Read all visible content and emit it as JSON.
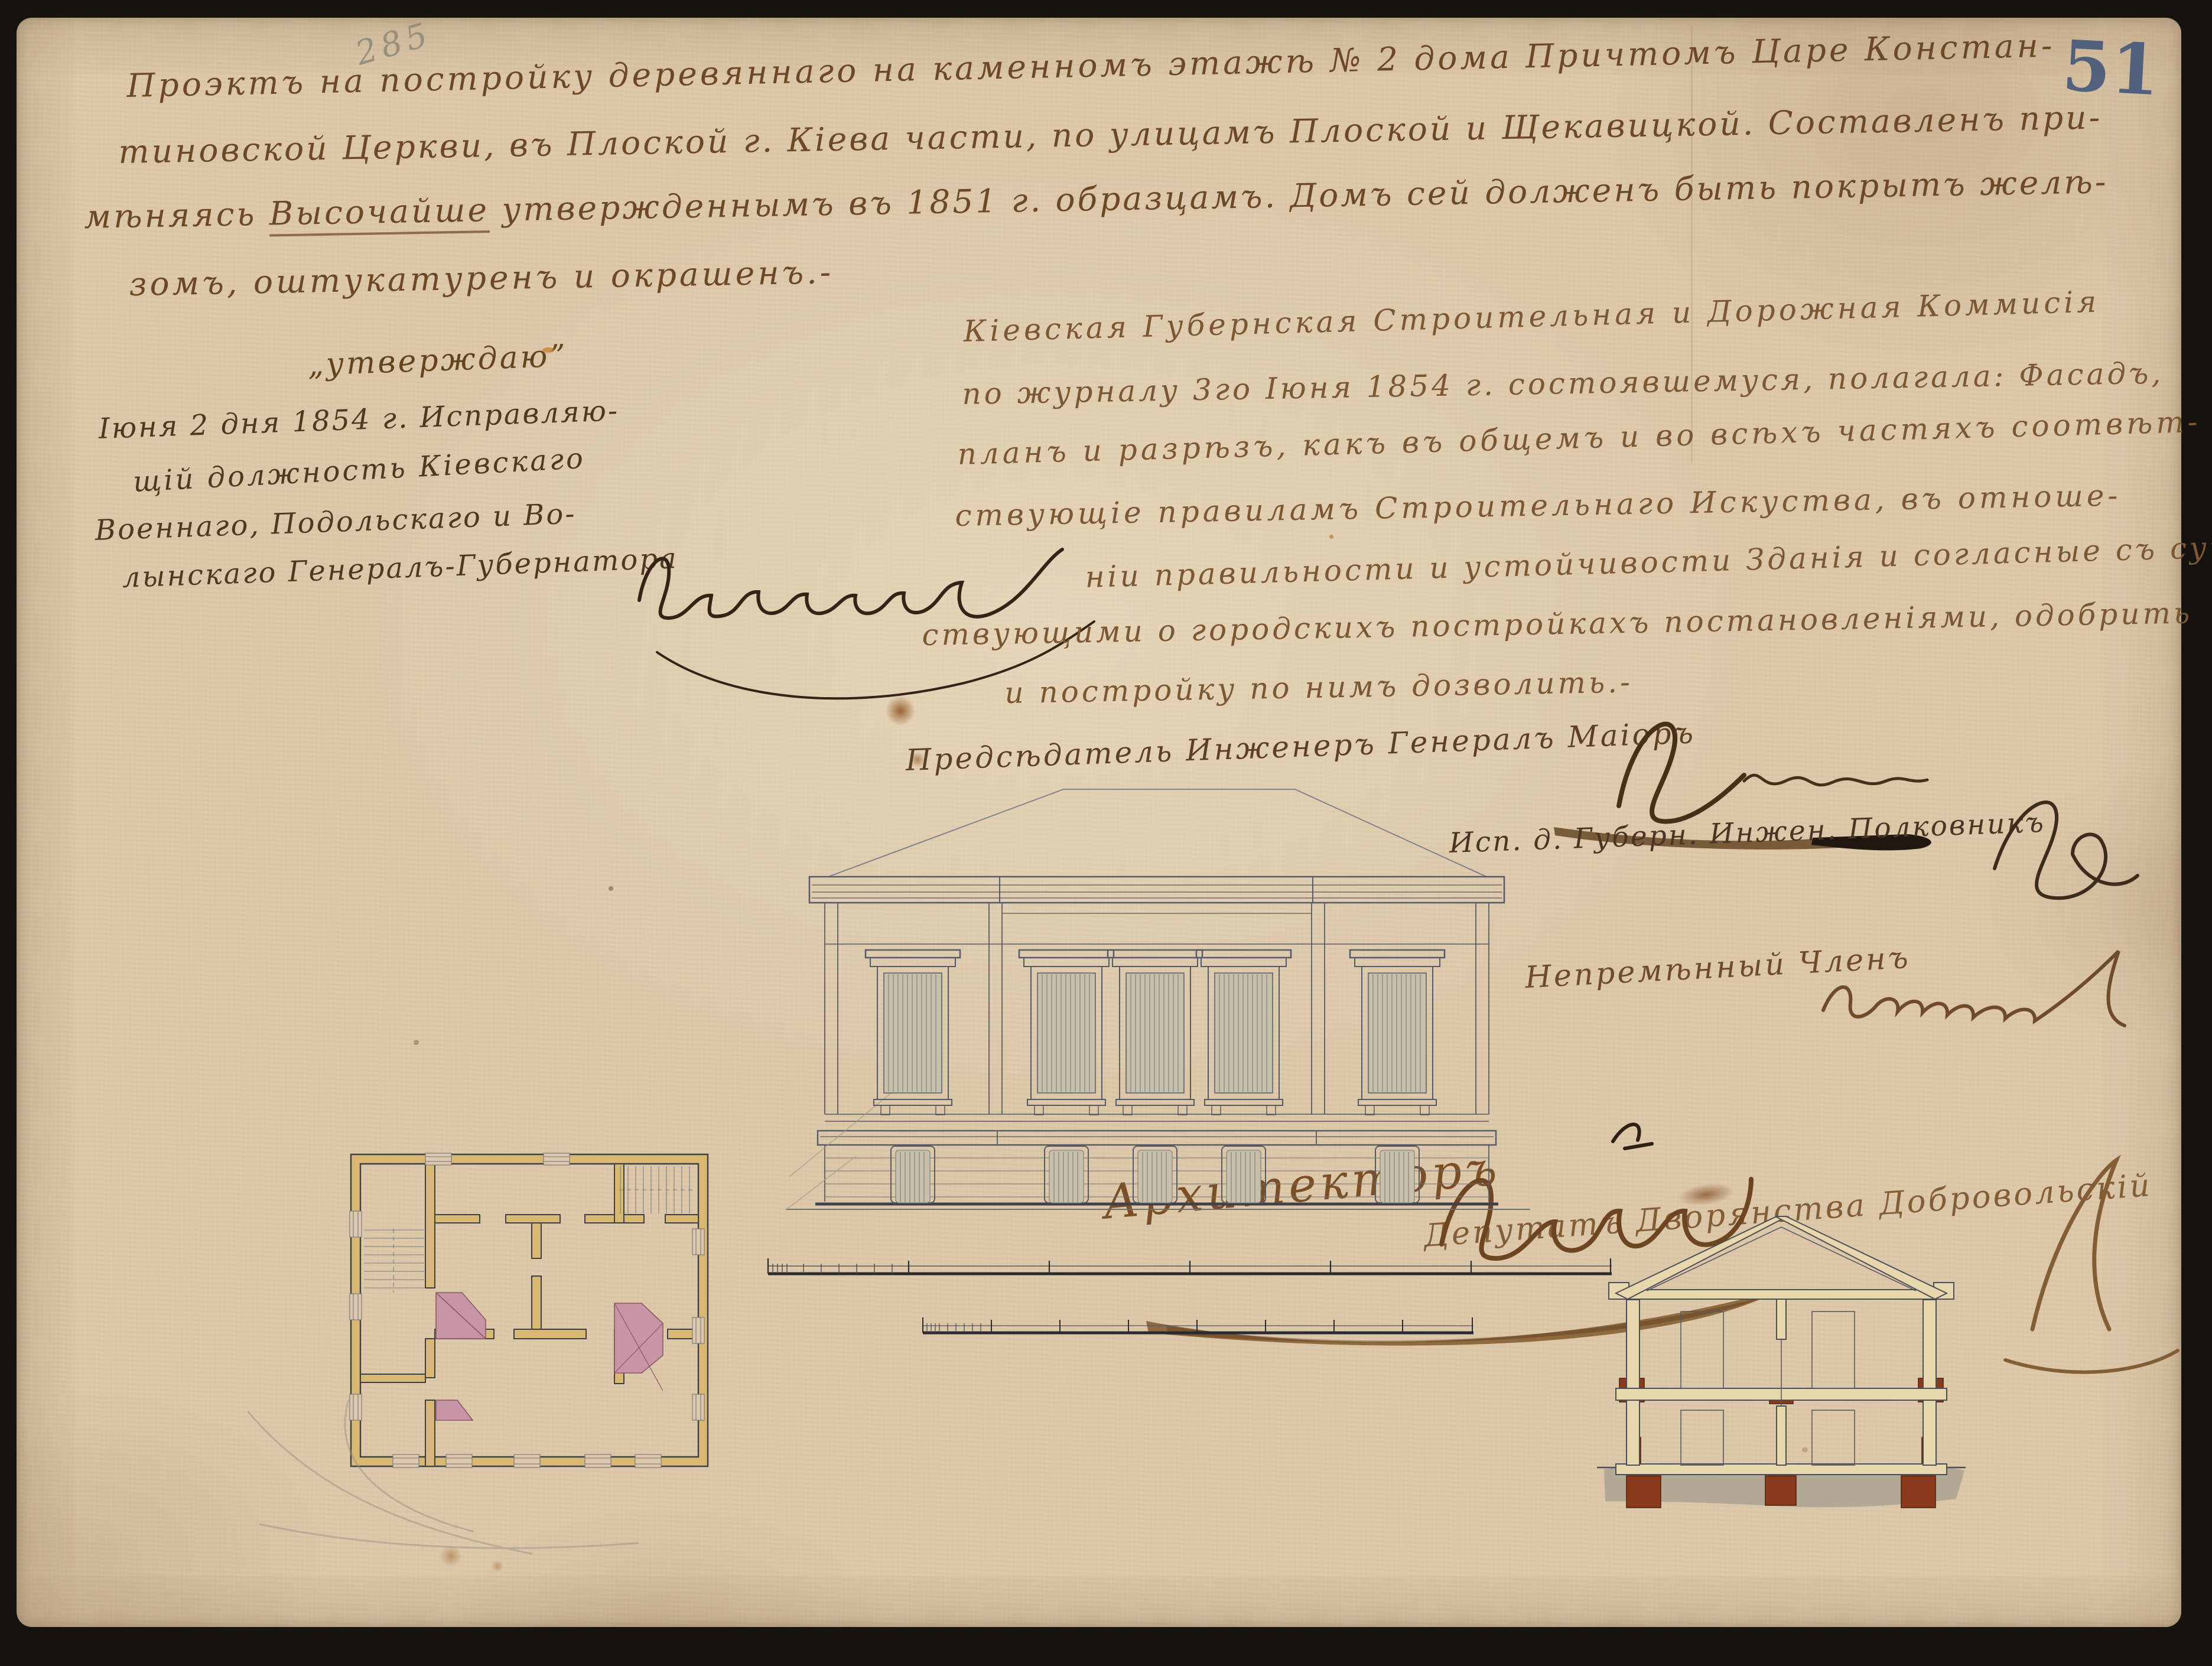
{
  "document": {
    "archive_folio_number": "51",
    "pencil_inventory_number": "285",
    "header": {
      "line1": "Проэктъ на постройку деревяннаго на каменномъ этажѣ № 2 дома Причтомъ Царе Констан-",
      "line2": "тиновской Церкви, въ Плоской г. Кіева части, по улицамъ Плоской и Щекавицкой. Составленъ при-",
      "line3_pre": "мѣняясь ",
      "line3_underlined": "Высочайше",
      "line3_post": " утвержденнымъ въ 1851 г. образцамъ. Домъ сей долженъ быть покрытъ желѣ-",
      "line4": "зомъ, оштукатуренъ и окрашенъ.-"
    },
    "approval": {
      "title": "„утверждаю”",
      "line1": "Іюня 2 дня 1854 г. Исправляю-",
      "line2": "щій должность Кіевскаго",
      "line3": "Военнаго, Подольскаго и Во-",
      "line4": "лынскаго Генералъ-Губернатора"
    },
    "commission_resolution": {
      "line1": "Кіевская Губернская Строительная и Дорожная Коммисія",
      "line2": "по журналу 3го Іюня 1854 г. состоявшемуся, полагала: Фасадъ,",
      "line3": "планъ и разрѣзъ, какъ въ общемъ и во всѣхъ частяхъ соотвѣт-",
      "line4": "ствующіе правиламъ Строительнаго Искуства, въ отноше-",
      "line5": "ніи правильности и устойчивости Зданія и согласные съ суще-",
      "line6": "ствующими о городскихъ постройкахъ постановленіями, одобрить",
      "line7": "и постройку по нимъ дозволить.-"
    },
    "signatures": {
      "chairman_label": "Предсѣдатель Инженеръ Генералъ Маіоръ",
      "official1_label": "Исп. д. Губерн. Инжен. Полковникъ",
      "official2_label": "Непремѣнный Членъ",
      "official3_label": "Депутатъ Дворянства Добровольскій",
      "architect_label": "Архитекторъ"
    }
  }
}
